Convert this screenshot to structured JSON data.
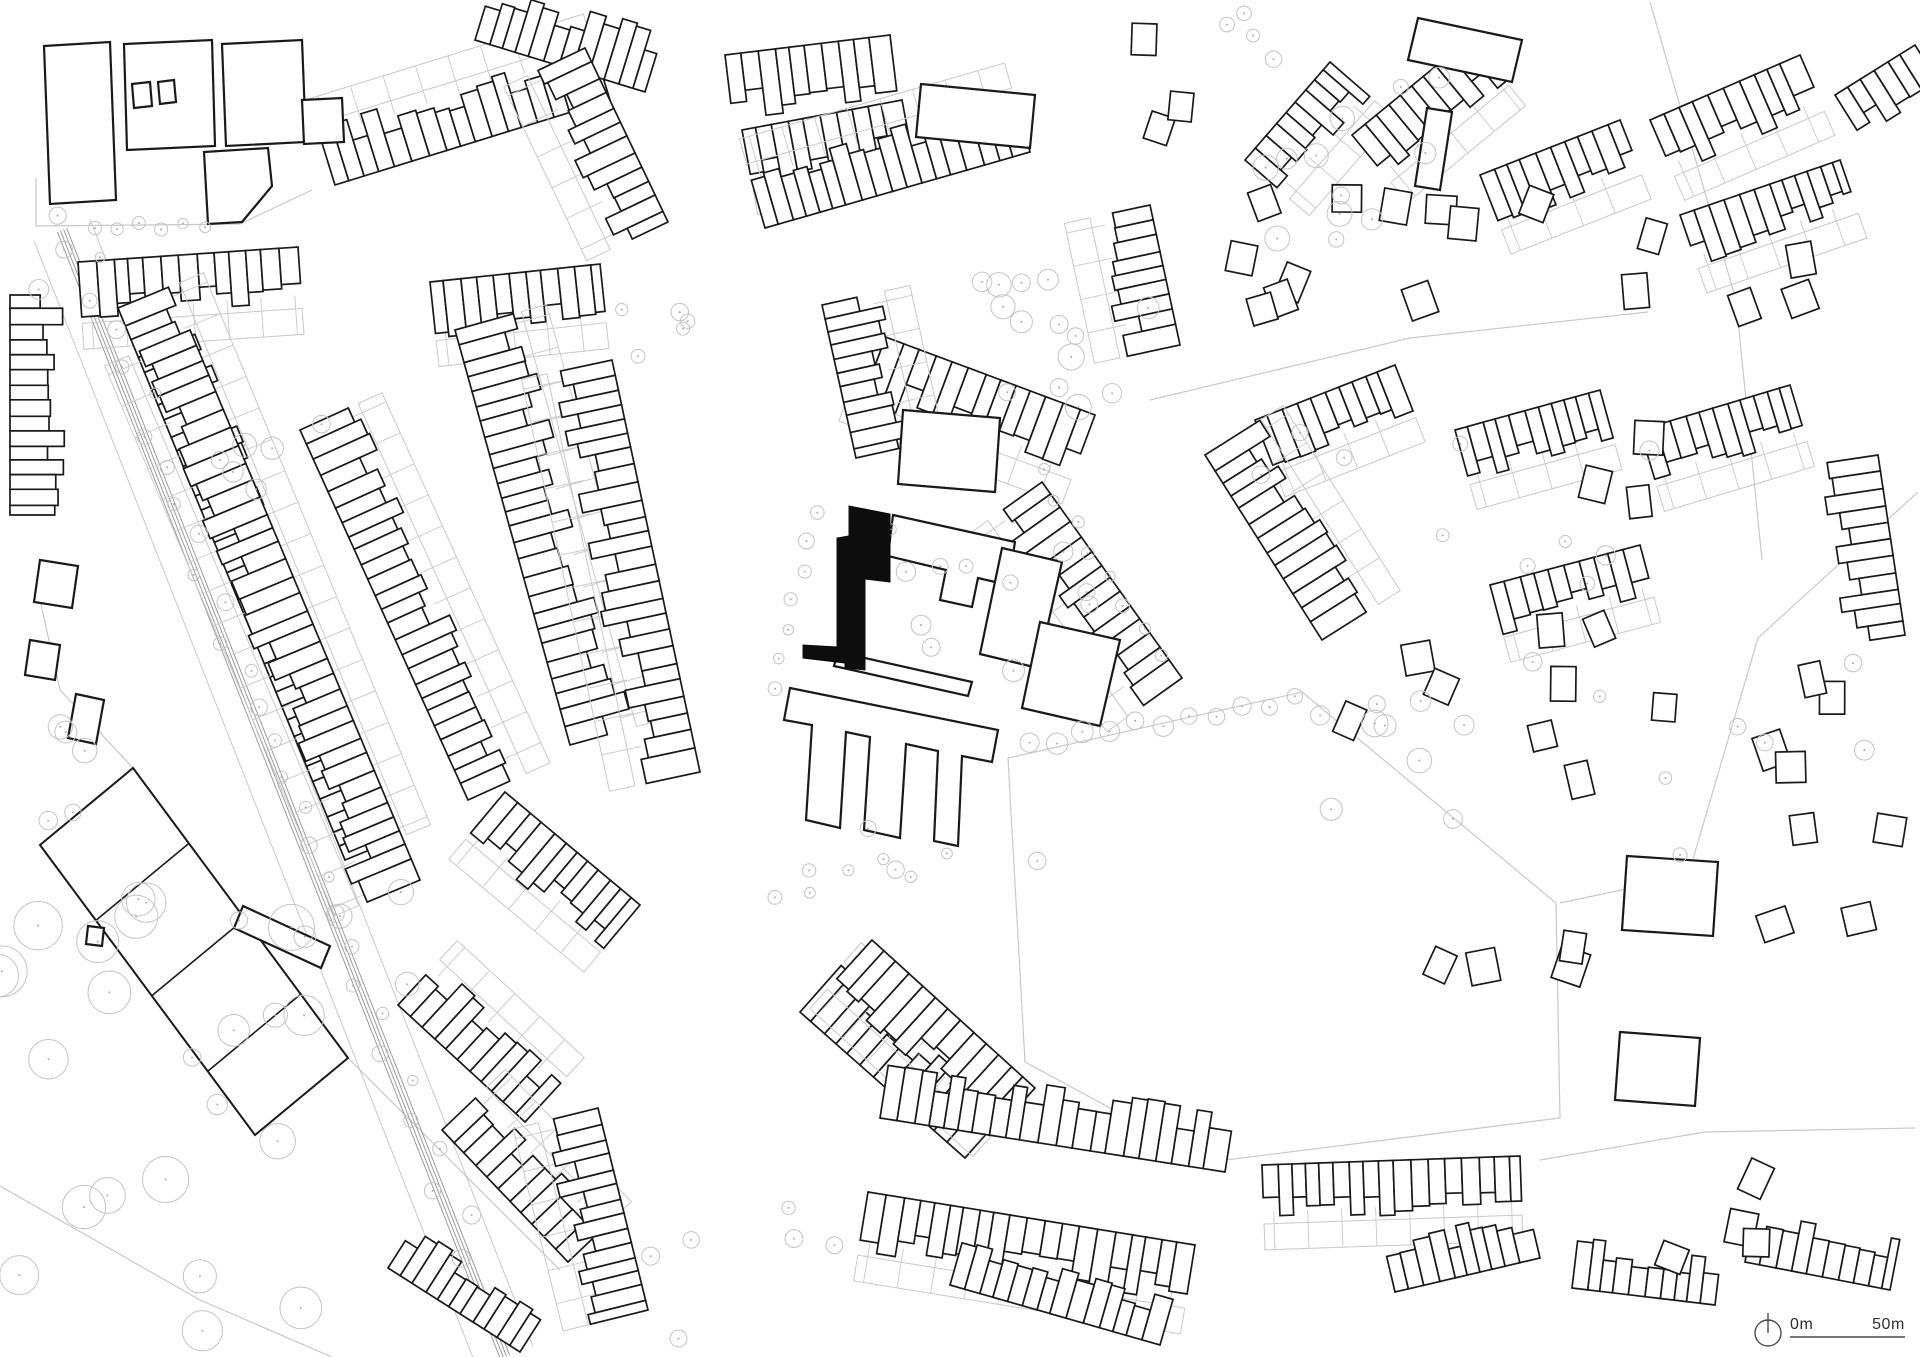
{
  "drawing": {
    "type": "urban figure-ground site plan",
    "site_marker": "solid black building"
  },
  "colors": {
    "background": "#ffffff",
    "building_outline": "#1a1a1a",
    "building_fill": "#ffffff",
    "site_fill": "#0d0d0d",
    "parcel_gray": "#c9c9c9",
    "tree_gray": "#c4c4c4",
    "tree_dot": "#ababab",
    "rail_gray": "#9c9c9c",
    "scale_line": "#4a4a4a",
    "scale_text": "#2e2e2e"
  },
  "map": {
    "scale_bar": {
      "start_label": "0m",
      "end_label": "50m",
      "x_start": 1790,
      "x_end": 1905,
      "y_line": 1337,
      "y_text": 1329
    },
    "north_arrow": {
      "cx": 1768,
      "cy": 1333,
      "r": 13,
      "tip_y": 1313
    },
    "site_building": [
      [
        849,
        506
      ],
      [
        890,
        514
      ],
      [
        890,
        582
      ],
      [
        865,
        579
      ],
      [
        865,
        670
      ],
      [
        845,
        668
      ],
      [
        845,
        663
      ],
      [
        803,
        658
      ],
      [
        803,
        645
      ],
      [
        837,
        647
      ],
      [
        837,
        538
      ],
      [
        849,
        536
      ]
    ],
    "campus_buildings": [
      [
        [
          44,
          46
        ],
        [
          110,
          42
        ],
        [
          116,
          200
        ],
        [
          50,
          204
        ]
      ],
      [
        [
          124,
          44
        ],
        [
          212,
          40
        ],
        [
          215,
          146
        ],
        [
          127,
          150
        ]
      ],
      [
        [
          222,
          44
        ],
        [
          302,
          40
        ],
        [
          306,
          142
        ],
        [
          226,
          146
        ]
      ],
      [
        [
          302,
          100
        ],
        [
          342,
          98
        ],
        [
          344,
          142
        ],
        [
          304,
          144
        ]
      ],
      [
        [
          204,
          152
        ],
        [
          268,
          148
        ],
        [
          272,
          186
        ],
        [
          242,
          222
        ],
        [
          208,
          224
        ]
      ],
      [
        [
          132,
          84
        ],
        [
          150,
          82
        ],
        [
          152,
          106
        ],
        [
          134,
          108
        ]
      ],
      [
        [
          158,
          82
        ],
        [
          174,
          80
        ],
        [
          176,
          102
        ],
        [
          160,
          104
        ]
      ]
    ],
    "special_buildings": [
      [
        [
          921,
          84
        ],
        [
          1035,
          95
        ],
        [
          1030,
          148
        ],
        [
          916,
          137
        ]
      ],
      [
        [
          903,
          410
        ],
        [
          1000,
          418
        ],
        [
          995,
          492
        ],
        [
          898,
          484
        ]
      ],
      [
        [
          893,
          515
        ],
        [
          1015,
          542
        ],
        [
          1008,
          585
        ],
        [
          978,
          578
        ],
        [
          972,
          607
        ],
        [
          940,
          600
        ],
        [
          946,
          570
        ],
        [
          888,
          556
        ]
      ],
      [
        [
          1002,
          548
        ],
        [
          1062,
          562
        ],
        [
          1038,
          668
        ],
        [
          980,
          654
        ]
      ],
      [
        [
          838,
          652
        ],
        [
          972,
          682
        ],
        [
          968,
          696
        ],
        [
          834,
          666
        ]
      ],
      [
        [
          790,
          688
        ],
        [
          998,
          730
        ],
        [
          992,
          762
        ],
        [
          962,
          756
        ],
        [
          958,
          846
        ],
        [
          934,
          841
        ],
        [
          938,
          751
        ],
        [
          906,
          744
        ],
        [
          900,
          838
        ],
        [
          864,
          830
        ],
        [
          870,
          737
        ],
        [
          846,
          732
        ],
        [
          840,
          828
        ],
        [
          806,
          820
        ],
        [
          812,
          725
        ],
        [
          784,
          720
        ]
      ],
      [
        [
          1040,
          622
        ],
        [
          1120,
          640
        ],
        [
          1100,
          726
        ],
        [
          1022,
          708
        ]
      ],
      [
        [
          243,
          906
        ],
        [
          330,
          946
        ],
        [
          321,
          968
        ],
        [
          234,
          928
        ]
      ],
      [
        [
          1627,
          856
        ],
        [
          1718,
          862
        ],
        [
          1713,
          936
        ],
        [
          1622,
          930
        ]
      ],
      [
        [
          1620,
          1032
        ],
        [
          1700,
          1038
        ],
        [
          1695,
          1106
        ],
        [
          1615,
          1100
        ]
      ],
      [
        [
          1418,
          18
        ],
        [
          1522,
          40
        ],
        [
          1512,
          82
        ],
        [
          1408,
          60
        ]
      ],
      [
        [
          1427,
          108
        ],
        [
          1452,
          112
        ],
        [
          1440,
          190
        ],
        [
          1415,
          186
        ]
      ],
      [
        [
          88,
          926
        ],
        [
          104,
          928
        ],
        [
          102,
          946
        ],
        [
          86,
          944
        ]
      ],
      [
        [
          76,
          694
        ],
        [
          104,
          700
        ],
        [
          96,
          744
        ],
        [
          68,
          738
        ]
      ],
      [
        [
          40,
          560
        ],
        [
          78,
          566
        ],
        [
          72,
          608
        ],
        [
          34,
          602
        ]
      ],
      [
        [
          30,
          640
        ],
        [
          60,
          645
        ],
        [
          55,
          680
        ],
        [
          25,
          675
        ]
      ]
    ],
    "terrace_rows": [
      [
        78,
        262,
        298,
        247,
        46,
        1,
        13,
        20,
        1
      ],
      [
        118,
        308,
        345,
        860,
        50,
        -1,
        14,
        20,
        1
      ],
      [
        190,
        330,
        420,
        880,
        50,
        1,
        14,
        20,
        1
      ],
      [
        300,
        430,
        468,
        800,
        48,
        -1,
        13,
        19,
        1
      ],
      [
        430,
        282,
        600,
        264,
        44,
        1,
        13,
        18,
        1
      ],
      [
        455,
        330,
        570,
        745,
        52,
        -1,
        14,
        20,
        1
      ],
      [
        612,
        360,
        700,
        772,
        50,
        1,
        14,
        19,
        1
      ],
      [
        505,
        792,
        640,
        905,
        46,
        1,
        13,
        18,
        1
      ],
      [
        335,
        185,
        610,
        100,
        48,
        -1,
        13,
        19,
        1
      ],
      [
        475,
        40,
        645,
        92,
        50,
        -1,
        13,
        18,
        0
      ],
      [
        585,
        48,
        668,
        222,
        48,
        1,
        14,
        19,
        1
      ],
      [
        725,
        55,
        890,
        35,
        52,
        1,
        13,
        19,
        0
      ],
      [
        742,
        130,
        902,
        100,
        45,
        1,
        13,
        18,
        1
      ],
      [
        765,
        228,
        1030,
        152,
        50,
        -1,
        13,
        19,
        1
      ],
      [
        872,
        332,
        1095,
        415,
        52,
        1,
        14,
        20,
        1
      ],
      [
        1150,
        205,
        1180,
        345,
        46,
        1,
        13,
        18,
        1
      ],
      [
        1245,
        160,
        1330,
        62,
        44,
        1,
        13,
        18,
        1
      ],
      [
        1352,
        135,
        1470,
        38,
        46,
        1,
        13,
        18,
        1
      ],
      [
        1480,
        175,
        1620,
        120,
        44,
        1,
        13,
        18,
        1
      ],
      [
        1650,
        120,
        1800,
        55,
        46,
        1,
        13,
        18,
        1
      ],
      [
        1835,
        95,
        1915,
        45,
        40,
        1,
        12,
        17,
        0
      ],
      [
        1680,
        215,
        1840,
        160,
        42,
        1,
        12,
        17,
        1
      ],
      [
        1255,
        420,
        1395,
        365,
        42,
        1,
        12,
        17,
        1
      ],
      [
        1455,
        430,
        1600,
        390,
        42,
        1,
        12,
        17,
        1
      ],
      [
        1640,
        430,
        1790,
        385,
        44,
        1,
        12,
        17,
        1
      ],
      [
        1878,
        455,
        1905,
        635,
        46,
        1,
        13,
        18,
        0
      ],
      [
        1490,
        585,
        1640,
        545,
        40,
        1,
        12,
        17,
        1
      ],
      [
        1042,
        482,
        1182,
        678,
        50,
        1,
        14,
        20,
        1
      ],
      [
        1205,
        455,
        1322,
        640,
        50,
        -1,
        14,
        20,
        1
      ],
      [
        800,
        1012,
        965,
        1158,
        50,
        -1,
        14,
        19,
        1
      ],
      [
        872,
        940,
        1035,
        1088,
        50,
        1,
        14,
        19,
        1
      ],
      [
        880,
        1118,
        1225,
        1172,
        48,
        -1,
        13,
        19,
        0
      ],
      [
        868,
        1192,
        1195,
        1245,
        48,
        1,
        13,
        19,
        1
      ],
      [
        1262,
        1165,
        1520,
        1156,
        44,
        1,
        13,
        18,
        1
      ],
      [
        950,
        1285,
        1160,
        1345,
        42,
        -1,
        13,
        18,
        0
      ],
      [
        1395,
        1292,
        1540,
        1258,
        40,
        -1,
        12,
        17,
        0
      ],
      [
        1572,
        1288,
        1715,
        1305,
        40,
        -1,
        12,
        17,
        0
      ],
      [
        1745,
        1262,
        1890,
        1290,
        40,
        -1,
        12,
        17,
        0
      ],
      [
        398,
        1005,
        525,
        1122,
        46,
        -1,
        13,
        18,
        1
      ],
      [
        442,
        1130,
        568,
        1262,
        46,
        -1,
        13,
        18,
        1
      ],
      [
        388,
        1268,
        520,
        1352,
        40,
        -1,
        13,
        18,
        0
      ],
      [
        598,
        1108,
        648,
        1310,
        46,
        1,
        13,
        18,
        1
      ],
      [
        10,
        295,
        10,
        515,
        42,
        -1,
        13,
        18,
        0
      ],
      [
        822,
        305,
        856,
        458,
        48,
        -1,
        13,
        18,
        1
      ]
    ],
    "detached_clusters": [
      [
        1330,
        255,
        80,
        60,
        4
      ],
      [
        1505,
        255,
        90,
        55,
        4
      ],
      [
        1706,
        305,
        110,
        70,
        5
      ],
      [
        1452,
        652,
        110,
        85,
        5
      ],
      [
        1652,
        700,
        120,
        80,
        5
      ],
      [
        1820,
        865,
        70,
        90,
        4
      ],
      [
        1480,
        985,
        95,
        75,
        4
      ],
      [
        1665,
        1230,
        95,
        55,
        4
      ],
      [
        1165,
        75,
        65,
        55,
        3
      ],
      [
        1845,
        705,
        55,
        70,
        3
      ],
      [
        1275,
        300,
        60,
        45,
        3
      ],
      [
        1600,
        480,
        80,
        60,
        3
      ]
    ],
    "tree_clusters": [
      [
        1060,
        360,
        110,
        85,
        14,
        7,
        14
      ],
      [
        1360,
        160,
        110,
        100,
        12,
        7,
        13
      ],
      [
        1390,
        760,
        85,
        65,
        9,
        8,
        14
      ],
      [
        120,
        1120,
        190,
        240,
        26,
        13,
        26
      ],
      [
        950,
        620,
        150,
        100,
        14,
        5,
        11
      ],
      [
        890,
        868,
        170,
        45,
        10,
        5,
        9
      ],
      [
        300,
        985,
        110,
        150,
        8,
        8,
        14
      ],
      [
        62,
        252,
        28,
        38,
        3,
        8,
        11
      ],
      [
        1500,
        525,
        240,
        150,
        10,
        6,
        10
      ],
      [
        1705,
        765,
        190,
        110,
        8,
        6,
        10
      ],
      [
        760,
        1272,
        110,
        70,
        6,
        6,
        9
      ],
      [
        260,
        432,
        75,
        65,
        6,
        8,
        12
      ],
      [
        30,
        762,
        55,
        110,
        6,
        8,
        13
      ],
      [
        640,
        300,
        55,
        75,
        5,
        6,
        9
      ],
      [
        1240,
        40,
        60,
        40,
        4,
        6,
        9
      ]
    ],
    "tree_lines": [
      [
        88,
        262,
        470,
        1255,
        30,
        5,
        9,
        16
      ],
      [
        95,
        228,
        205,
        224,
        6,
        5,
        7,
        4
      ],
      [
        1030,
        745,
        1295,
        697,
        11,
        7,
        11,
        6
      ],
      [
        815,
        512,
        772,
        688,
        7,
        5,
        8,
        5
      ],
      [
        1040,
        472,
        1162,
        655,
        8,
        5,
        8,
        6
      ]
    ],
    "gray_lines": [
      [
        [
          36,
          178
        ],
        [
          36,
          226
        ],
        [
          240,
          224
        ],
        [
          312,
          190
        ]
      ],
      [
        [
          1008,
          758
        ],
        [
          1302,
          692
        ],
        [
          1556,
          903
        ],
        [
          1560,
          1118
        ],
        [
          1210,
          1162
        ],
        [
          1025,
          1062
        ],
        [
          1008,
          758
        ]
      ],
      [
        [
          1150,
          400
        ],
        [
          1410,
          338
        ],
        [
          1648,
          312
        ]
      ],
      [
        [
          1650,
          2
        ],
        [
          1736,
          300
        ],
        [
          1762,
          560
        ]
      ],
      [
        [
          1918,
          492
        ],
        [
          1758,
          638
        ],
        [
          1688,
          876
        ]
      ],
      [
        [
          1560,
          903
        ],
        [
          1688,
          876
        ]
      ],
      [
        [
          1540,
          1160
        ],
        [
          1705,
          1132
        ],
        [
          1915,
          1128
        ]
      ],
      [
        [
          0,
          1186
        ],
        [
          200,
          1300
        ],
        [
          332,
          1357
        ]
      ],
      [
        [
          348,
          1058
        ],
        [
          560,
          1270
        ]
      ],
      [
        [
          133,
          768
        ],
        [
          60,
          690
        ],
        [
          40,
          600
        ]
      ]
    ],
    "railway": {
      "p1": [
        62,
        230
      ],
      "p2": [
        505,
        1357
      ],
      "rail_offsets": [
        -5,
        -1.7,
        1.7,
        5
      ],
      "edge_offsets": [
        -30,
        30
      ]
    },
    "field": {
      "origin": [
        40,
        845
      ],
      "u": [
        93,
        -77
      ],
      "v": [
        215,
        290
      ],
      "dividers": [
        0.26,
        0.52,
        0.78
      ]
    }
  }
}
